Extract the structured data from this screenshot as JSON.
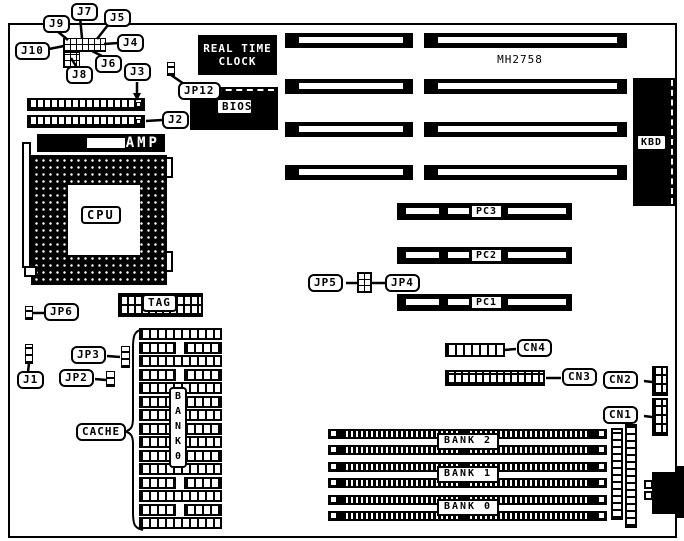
{
  "board_model": "MH2758",
  "chips": {
    "rtc_line1": "REAL TIME",
    "rtc_line2": "CLOCK",
    "bios": "BIOS",
    "cpu": "CPU",
    "amp": "AMP",
    "tag": "TAG",
    "kbd": "KBD"
  },
  "jumpers": {
    "j1": "J1",
    "j2": "J2",
    "j3": "J3",
    "j4": "J4",
    "j5": "J5",
    "j6": "J6",
    "j7": "J7",
    "j8": "J8",
    "j9": "J9",
    "j10": "J10",
    "jp2": "JP2",
    "jp3": "JP3",
    "jp4": "JP4",
    "jp5": "JP5",
    "jp6": "JP6",
    "jp12": "JP12"
  },
  "slots": {
    "pc1": "PC1",
    "pc2": "PC2",
    "pc3": "PC3"
  },
  "connectors": {
    "cn1": "CN1",
    "cn2": "CN2",
    "cn3": "CN3",
    "cn4": "CN4"
  },
  "memory": {
    "cache": "CACHE",
    "bank0_vertical": "B\nA\nN\nK\n0",
    "bank2": "BANK 2",
    "bank1": "BANK 1",
    "bank0": "BANK 0"
  },
  "colors": {
    "ink": "#000000",
    "paper": "#ffffff"
  }
}
